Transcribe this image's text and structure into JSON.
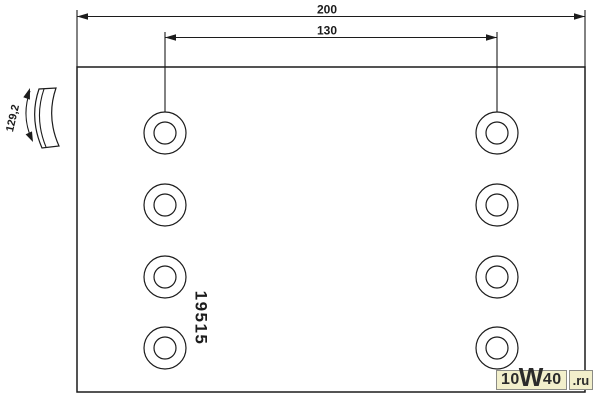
{
  "drawing": {
    "type": "technical-drawing",
    "part_number": "19515",
    "labels": {
      "overall_width": "200",
      "hole_spacing": "130",
      "arc_length": "129,2"
    },
    "line_color": "#1c1c1c",
    "background": "#ffffff",
    "outline": {
      "x": 77,
      "y": 67,
      "w": 508,
      "h": 325
    },
    "dim200": {
      "y": 16.5,
      "x1": 77,
      "x2": 585,
      "label_x": 327,
      "label_y": 13.5
    },
    "dim130": {
      "y": 37.5,
      "x1": 165,
      "x2": 497,
      "label_x": 327,
      "label_y": 34.5
    },
    "ext_lines": [
      [
        77,
        10,
        77,
        67
      ],
      [
        585,
        10,
        585,
        67
      ],
      [
        165,
        32,
        165,
        112
      ],
      [
        497,
        32,
        497,
        112
      ]
    ],
    "holes": {
      "columns_x": [
        165,
        497
      ],
      "rows_y": [
        133,
        205,
        277,
        348
      ],
      "outer_r": 21,
      "inner_r": 11
    },
    "part_number_pos": {
      "x": 200,
      "y": 318,
      "rotate": 90,
      "size": 17
    },
    "side_profile": {
      "dim_arc": "M 30,91 Q 21,116 32,140",
      "band": "M 39,89 Q 29,118 42,148 L 59,146 Q 46,117 56,88 Z",
      "inner_arc": "M 44,89 Q 34,118 46,147",
      "arrow_top": "30,88 29.9,99.6 23.3,97.2",
      "arrow_bottom": "33,142 25.6,134.4 32,131.4",
      "label_x": 16,
      "label_y": 119,
      "label_rotate": -77,
      "label_size": 11
    }
  },
  "watermark": {
    "prefix": "10",
    "big": "W",
    "suffix": "40",
    "tld": ".ru",
    "bg": "#f2efcb",
    "border": "#8b8b85",
    "text_color": "#2b2b2b"
  }
}
